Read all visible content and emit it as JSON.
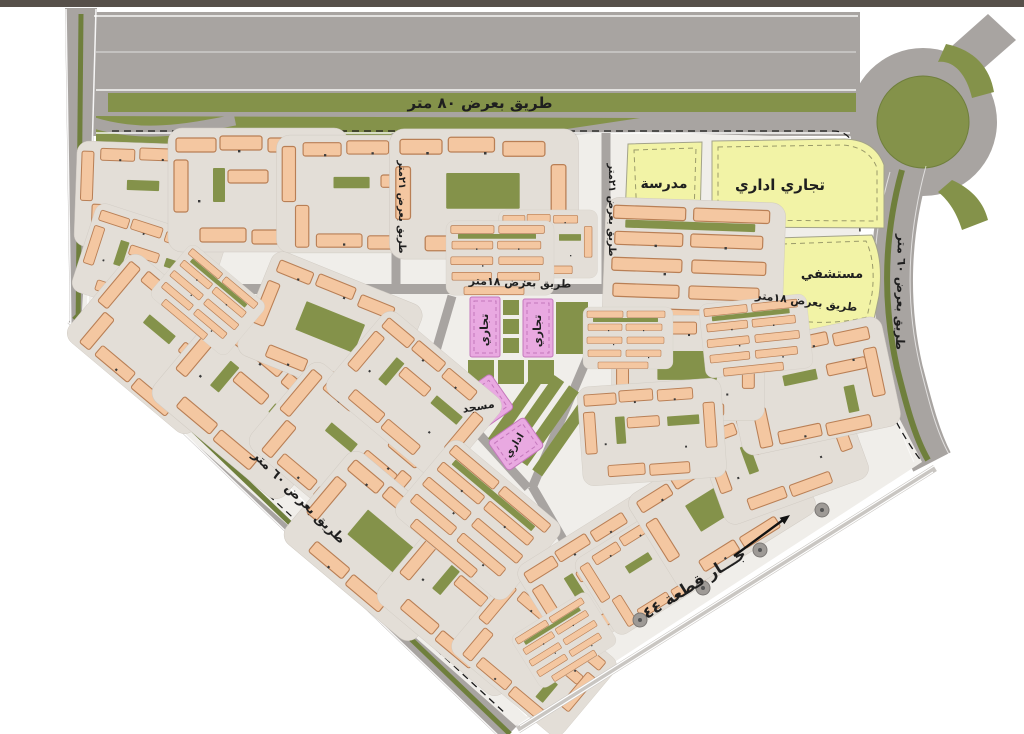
{
  "labels": {
    "road_width_80": "طريق بعرض ٨٠ متر",
    "road_width_60_left": "طريق بعرض ٦٠ متر",
    "road_width_60_right": "طريق بعرض ٦٠ متر",
    "road_width_21_a": "طريق بعرض ٢١متر",
    "road_width_21_b": "طريق بعرض ٢١متر",
    "road_width_18_center": "طريق بعرض ١٨متر",
    "road_width_18_right": "طريق بعرض ١٨متر",
    "zone_school": "مدرسة",
    "zone_commercial_admin": "تجاري اداري",
    "zone_hospital": "مستشفي",
    "zone_commercial_a": "تجاري",
    "zone_commercial_b": "تجاري",
    "zone_mosque": "مسجد",
    "zone_admin": "اداري",
    "neighbor_plot": "جـــار قطعة ٤٤"
  },
  "colors": {
    "road": "#a8a4a1",
    "green": "#84924a",
    "green_dark": "#6f7f3c",
    "site": "#f0eeea",
    "zone_yellow": "#f2f3a6",
    "zone_pink": "#e9a9e1",
    "building": "#f4c7a1",
    "building_outline": "#b97f55",
    "courtyard": "#e3ded7",
    "label": "#1f1f1f",
    "top_bar": "#57504a"
  }
}
